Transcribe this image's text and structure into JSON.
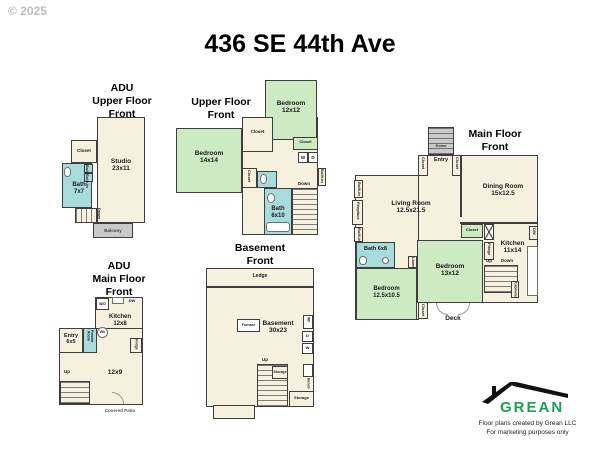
{
  "copyright": "© 2025",
  "title": "436 SE 44th Ave",
  "logo": {
    "brand": "GREAN",
    "credit": "Floor plans created by Grean LLC\nFor marketing purposes only",
    "brand_color": "#1a9e4f"
  },
  "colors": {
    "room_fill": "#f6f1de",
    "bedroom_fill": "#cdeac3",
    "bath_fill": "#a8dbdc",
    "stairs_fill": "#c9c9c9",
    "wall": "#3e3e3e"
  },
  "plans": {
    "adu_upper": {
      "title": "ADU\nUpper Floor\nFront",
      "labels": {
        "closet": "Closet",
        "studio": "Studio\n23x11",
        "bath": "Bath\n7x7",
        "builtin1": "Built-in",
        "builtin2": "Built-in",
        "down": "Down",
        "balcony": "Balcony"
      }
    },
    "upper": {
      "title": "Upper Floor\nFront",
      "labels": {
        "bedroom2": "Bedroom\n12x12",
        "bedroom1": "Bedroom\n14x14",
        "closet1": "Closet",
        "closet2": "Closet",
        "closet3": "Closet",
        "washer": "W",
        "dryer": "D",
        "builtin": "Built-in",
        "down": "Down",
        "bath": "Bath\n6x10"
      }
    },
    "main": {
      "title": "Main Floor\nFront",
      "labels": {
        "down_entry": "Down",
        "entry": "Entry",
        "closet_left": "Closet",
        "closet_right": "Closet",
        "living": "Living Room\n12.5x21.5",
        "dining": "Dining Room\n15x12.5",
        "builtin1": "Built-in",
        "fireplace": "Fireplace",
        "builtin2": "Built-in",
        "bath": "Bath 6x8",
        "bedroom1": "Bedroom\n12.5x10.5",
        "linen": "Linen",
        "bedroom2": "Bedroom\n13x12",
        "closet_kitchen": "Closet",
        "fridge": "Fridge",
        "kitchen": "Kitchen\n11x14",
        "dw": "DW",
        "up": "Up",
        "down": "Down",
        "cabinets": "Cabinets",
        "closet_bottom": "Closet",
        "deck": "Deck"
      }
    },
    "adu_main": {
      "title": "ADU\nMain Floor\nFront",
      "labels": {
        "wd": "W/D",
        "dw": "DW",
        "kitchen": "Kitchen\n12x8",
        "wh": "Wh",
        "powder": "Powder\nRoom",
        "entry": "Entry\n6x5",
        "fridge": "Fridge",
        "room": "12x9",
        "up": "Up",
        "patio": "Covered Patio"
      }
    },
    "basement": {
      "title": "Basement\nFront",
      "labels": {
        "ledge": "Ledge",
        "furnace": "Furnace",
        "room": "Basement\n30x23",
        "wh": "Wh",
        "d": "D",
        "w": "W",
        "bench": "Bench",
        "up": "Up",
        "storage1": "Storage",
        "storage2": "Storage"
      }
    }
  }
}
